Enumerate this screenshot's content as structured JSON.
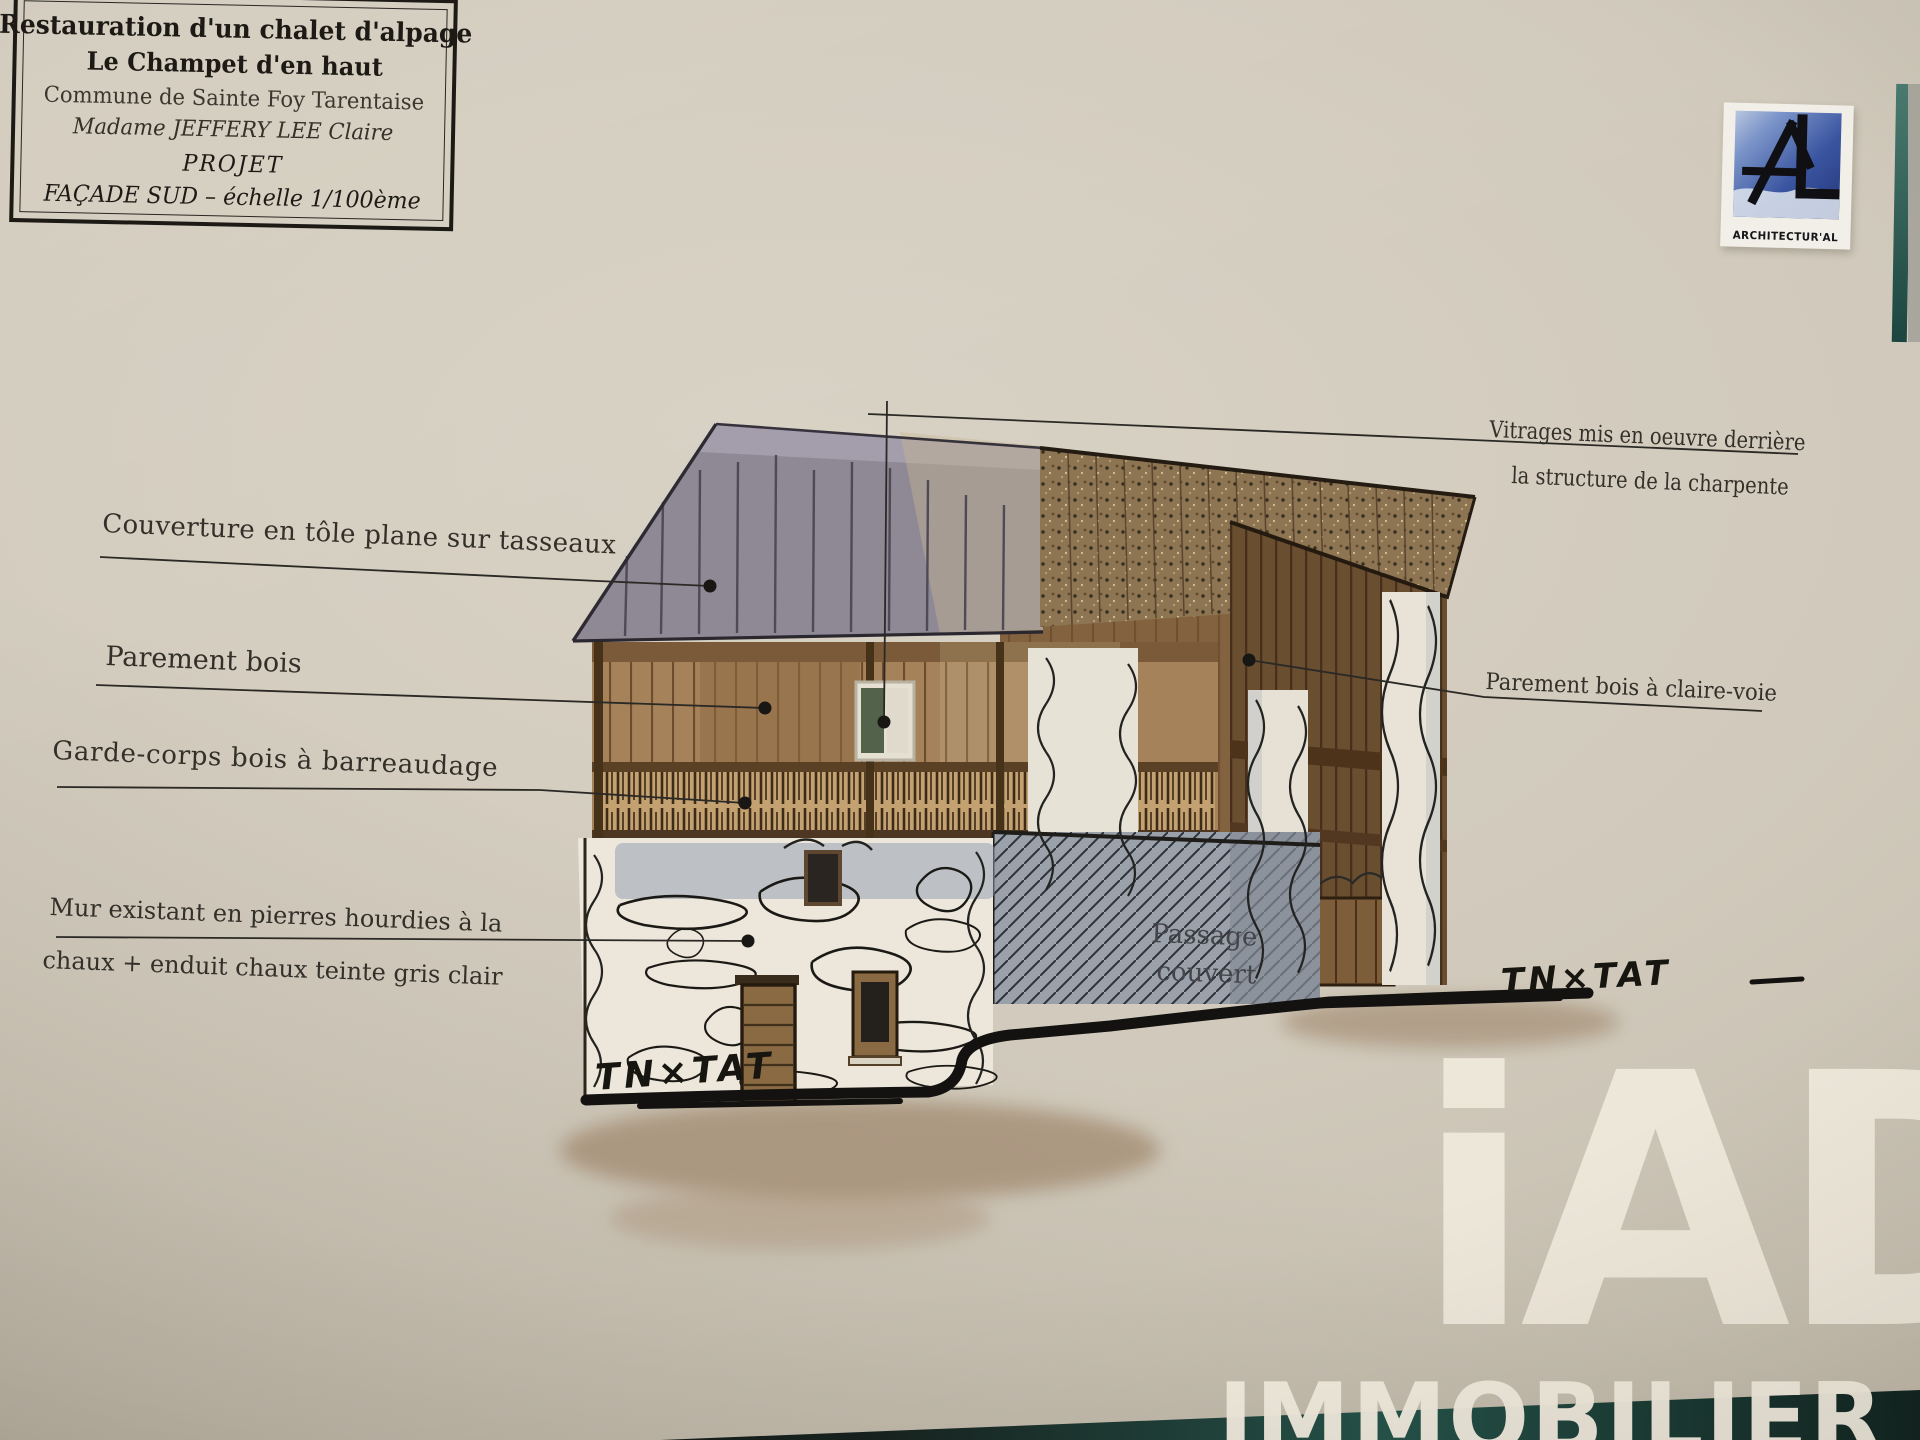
{
  "title_block": {
    "line1": "Restauration d'un chalet d'alpage",
    "line2": "Le Champet d'en haut",
    "line3": "Commune de Sainte Foy Tarentaise",
    "line4": "Madame JEFFERY LEE Claire",
    "line5": "PROJET",
    "line6": "FAÇADE SUD – échelle 1/100ème"
  },
  "architect_logo": {
    "monogram": "AL",
    "name": "ARCHITECTUR'AL"
  },
  "annotations": {
    "couverture": "Couverture en tôle plane sur tasseaux",
    "parement_bois": "Parement bois",
    "garde_corps": "Garde-corps bois à barreaudage",
    "mur_line1": "Mur existant en pierres hourdies à la",
    "mur_line2": "chaux + enduit chaux teinte gris clair",
    "vitrages_line1": "Vitrages mis en oeuvre derrière",
    "vitrages_line2": "la structure de la charpente",
    "claire_voie": "Parement bois à claire-voie",
    "passage_line1": "Passage",
    "passage_line2": "couvert",
    "tn_left": "TN×TAT",
    "tn_right": "TN×TAT"
  },
  "watermark": {
    "logo": "iAD",
    "caption": "IMMOBILIER"
  },
  "colors": {
    "paper": "#d1cabc",
    "ink": "#24221f",
    "roof_metal_gray": "#8f8996",
    "roof_wood_textured": "#8d7452",
    "wood_light": "#a5825a",
    "wood_dark": "#6a4e30",
    "stone_white": "#ece7da",
    "ground_shadow_brown": "#a18a6f",
    "table_teal": "#235249",
    "logo_blue": "#3a55a0",
    "watermark_cream": "#efe9dc"
  }
}
